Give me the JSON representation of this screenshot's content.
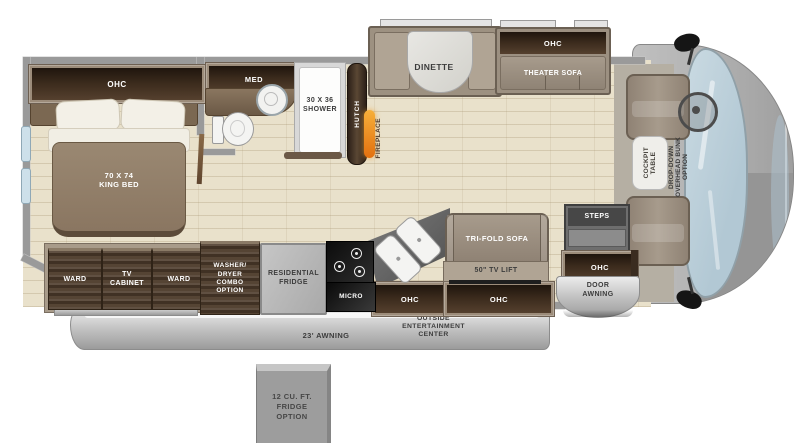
{
  "title": "Class A motorhome floor plan",
  "bedroom": {
    "ohc": "OHC",
    "bed_size": "70 x 74",
    "bed_name": "KING BED"
  },
  "bath": {
    "med": "MED",
    "shower_size": "30 x 36",
    "shower_name": "SHOWER"
  },
  "living": {
    "hutch": "HUTCH",
    "fireplace": "FIREPLACE",
    "dinette": "DINETTE",
    "theater_ohc": "OHC",
    "theater_sofa": "THEATER SOFA",
    "tri_fold_sofa": "TRI-FOLD SOFA",
    "tv_lift": "50\" TV LIFT",
    "ohc_left": "OHC",
    "ohc_right": "OHC"
  },
  "kitchen": {
    "washer_lines": [
      "WASHER/",
      "DRYER",
      "COMBO",
      "OPTION"
    ],
    "fridge_line1": "RESIDENTIAL",
    "fridge_line2": "FRIDGE",
    "micro": "MICRO"
  },
  "storage": {
    "ward_left": "WARD",
    "tv_line1": "TV",
    "tv_line2": "CABINET",
    "ward_right": "WARD"
  },
  "entry": {
    "steps": "STEPS",
    "ohc": "OHC",
    "door_line1": "DOOR",
    "door_line2": "AWNING"
  },
  "cab": {
    "table_line1": "COCKPIT",
    "table_line2": "TABLE",
    "bunk_lines": [
      "DROP-DOWN",
      "OVERHEAD BUNK",
      "OPTION"
    ]
  },
  "exterior": {
    "awning": "23' AWNING",
    "outside_lines": [
      "OUTSIDE",
      "ENTERTAINMENT",
      "CENTER"
    ],
    "fridge_option_lines": [
      "12 CU. FT.",
      "FRIDGE",
      "OPTION"
    ]
  },
  "colors": {
    "floor_tile": "#e9e1cb",
    "wall_gray": "#9a9a9a",
    "wood_dark": "#4e3c2c",
    "furniture_taupe": "#9c9081",
    "awning_silver": "#c6c6c6",
    "windshield_blue": "#bfd2dd",
    "fireplace_orange": "#e8831c"
  }
}
